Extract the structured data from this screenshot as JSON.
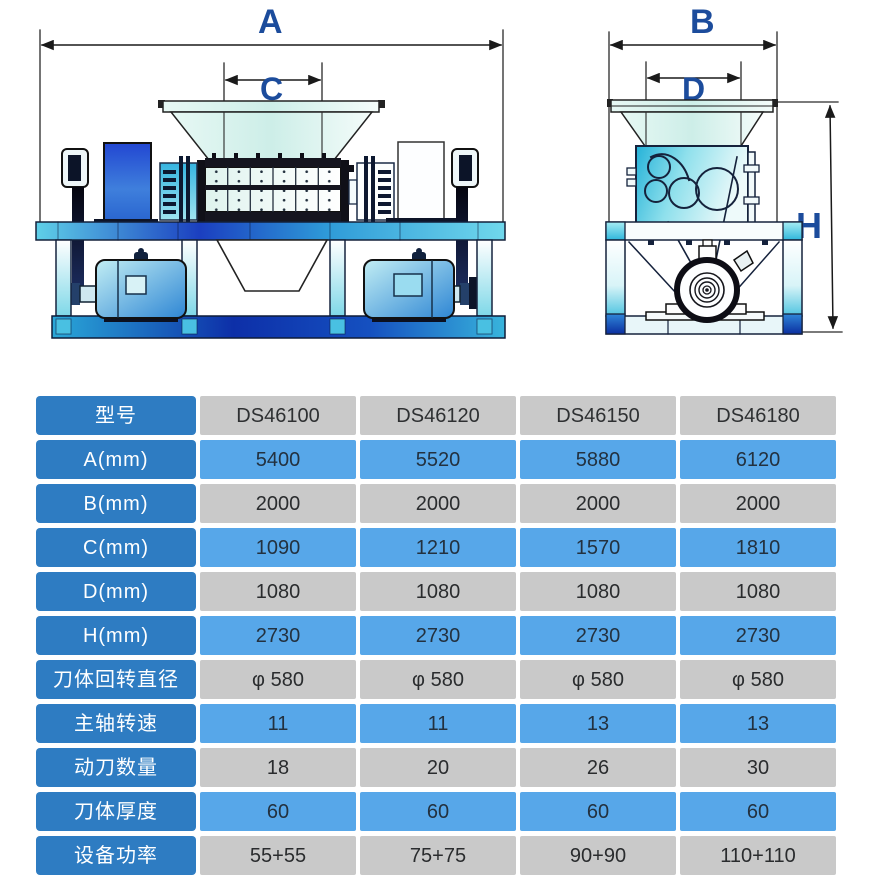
{
  "colors": {
    "dim_label_navy": "#1C4C9C",
    "table_label_blue": "#2E7CC2",
    "table_cell_blue": "#57A7E9",
    "table_cell_gray": "#C9C9C9",
    "machine_deep_blue": "#1B3FC0",
    "machine_cyan": "#49C0E2"
  },
  "diagram": {
    "labels": {
      "a": "A",
      "b": "B",
      "c": "C",
      "d": "D",
      "h": "H"
    }
  },
  "table": {
    "header": {
      "label": "型号",
      "models": [
        "DS46100",
        "DS46120",
        "DS46150",
        "DS46180"
      ]
    },
    "rows": [
      {
        "label": "A(mm)",
        "values": [
          "5400",
          "5520",
          "5880",
          "6120"
        ]
      },
      {
        "label": "B(mm)",
        "values": [
          "2000",
          "2000",
          "2000",
          "2000"
        ]
      },
      {
        "label": "C(mm)",
        "values": [
          "1090",
          "1210",
          "1570",
          "1810"
        ]
      },
      {
        "label": "D(mm)",
        "values": [
          "1080",
          "1080",
          "1080",
          "1080"
        ]
      },
      {
        "label": "H(mm)",
        "values": [
          "2730",
          "2730",
          "2730",
          "2730"
        ]
      },
      {
        "label": "刀体回转直径",
        "values": [
          "φ 580",
          "φ 580",
          "φ 580",
          "φ 580"
        ]
      },
      {
        "label": "主轴转速",
        "values": [
          "11",
          "11",
          "13",
          "13"
        ]
      },
      {
        "label": "动刀数量",
        "values": [
          "18",
          "20",
          "26",
          "30"
        ]
      },
      {
        "label": "刀体厚度",
        "values": [
          "60",
          "60",
          "60",
          "60"
        ]
      },
      {
        "label": "设备功率",
        "values": [
          "55+55",
          "75+75",
          "90+90",
          "110+110"
        ]
      }
    ]
  }
}
